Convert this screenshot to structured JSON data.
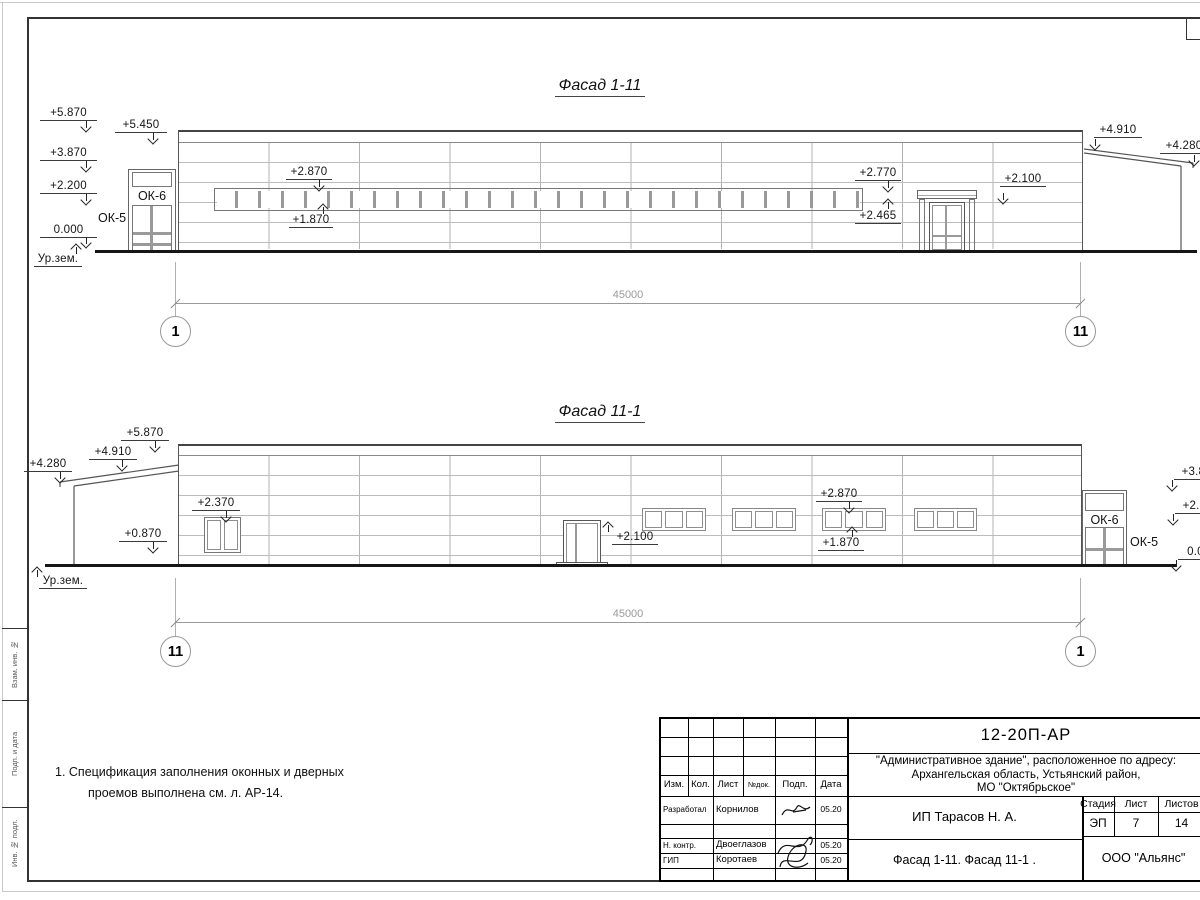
{
  "frame": {
    "margin_labels": [
      "Взам. инв. №",
      "Подп. и дата",
      "Инв. № подл."
    ]
  },
  "facade1": {
    "title": "Фасад 1-11",
    "marks": {
      "p5870": "+5.870",
      "p5450": "+5.450",
      "p3870": "+3.870",
      "p2200": "+2.200",
      "z0": "0.000",
      "ground": "Ур.зем.",
      "p2870": "+2.870",
      "p1870": "+1.870",
      "p2770": "+2.770",
      "p2465": "+2.465",
      "p2100": "+2.100",
      "p4910": "+4.910",
      "p4280": "+4.280"
    },
    "ok6": "ОК-6",
    "ok5": "ОК-5",
    "dim": "45000",
    "axis_left": "1",
    "axis_right": "11"
  },
  "facade2": {
    "title": "Фасад 11-1",
    "marks": {
      "p5870": "+5.870",
      "p4910": "+4.910",
      "p4280": "+4.280",
      "p2370": "+2.370",
      "p0870": "+0.870",
      "p2100": "+2.100",
      "p2870": "+2.870",
      "p1870": "+1.870",
      "p3870": "+3.870",
      "p2200": "+2.200",
      "z0": "0.000",
      "ground": "Ур.зем."
    },
    "ok6": "ОК-6",
    "ok5": "ОК-5",
    "dim": "45000",
    "axis_left": "11",
    "axis_right": "1"
  },
  "notes": {
    "line1": "1. Спецификация заполнения оконных и дверных",
    "line2": "проемов выполнена см. л. АР-14."
  },
  "titleblock": {
    "doc": "12-20П-АР",
    "addr1": "\"Административное здание\", расположенное по адресу:",
    "addr2": "Архангельская область, Устьянский район,",
    "addr3": "МО \"Октябрьское\"",
    "col_izm": "Изм.",
    "col_kol": "Кол.",
    "col_list": "Лист",
    "col_doc": "№док.",
    "col_podp": "Подп.",
    "col_data": "Дата",
    "r1_role": "Разработал",
    "r1_name": "Корнилов",
    "r1_date": "05.20",
    "r3_role": "Н. контр.",
    "r3_name": "Двоеглазов",
    "r3_date": "05.20",
    "r4_role": "ГИП",
    "r4_name": "Коротаев",
    "r4_date": "05.20",
    "client": "ИП Тарасов Н. А.",
    "stage_label": "Стадия",
    "list_label": "Лист",
    "listov_label": "Листов",
    "stage": "ЭП",
    "list": "7",
    "listov": "14",
    "doc_title": "Фасад 1-11. Фасад 11-1 .",
    "company": "ООО \"Альянс\""
  }
}
